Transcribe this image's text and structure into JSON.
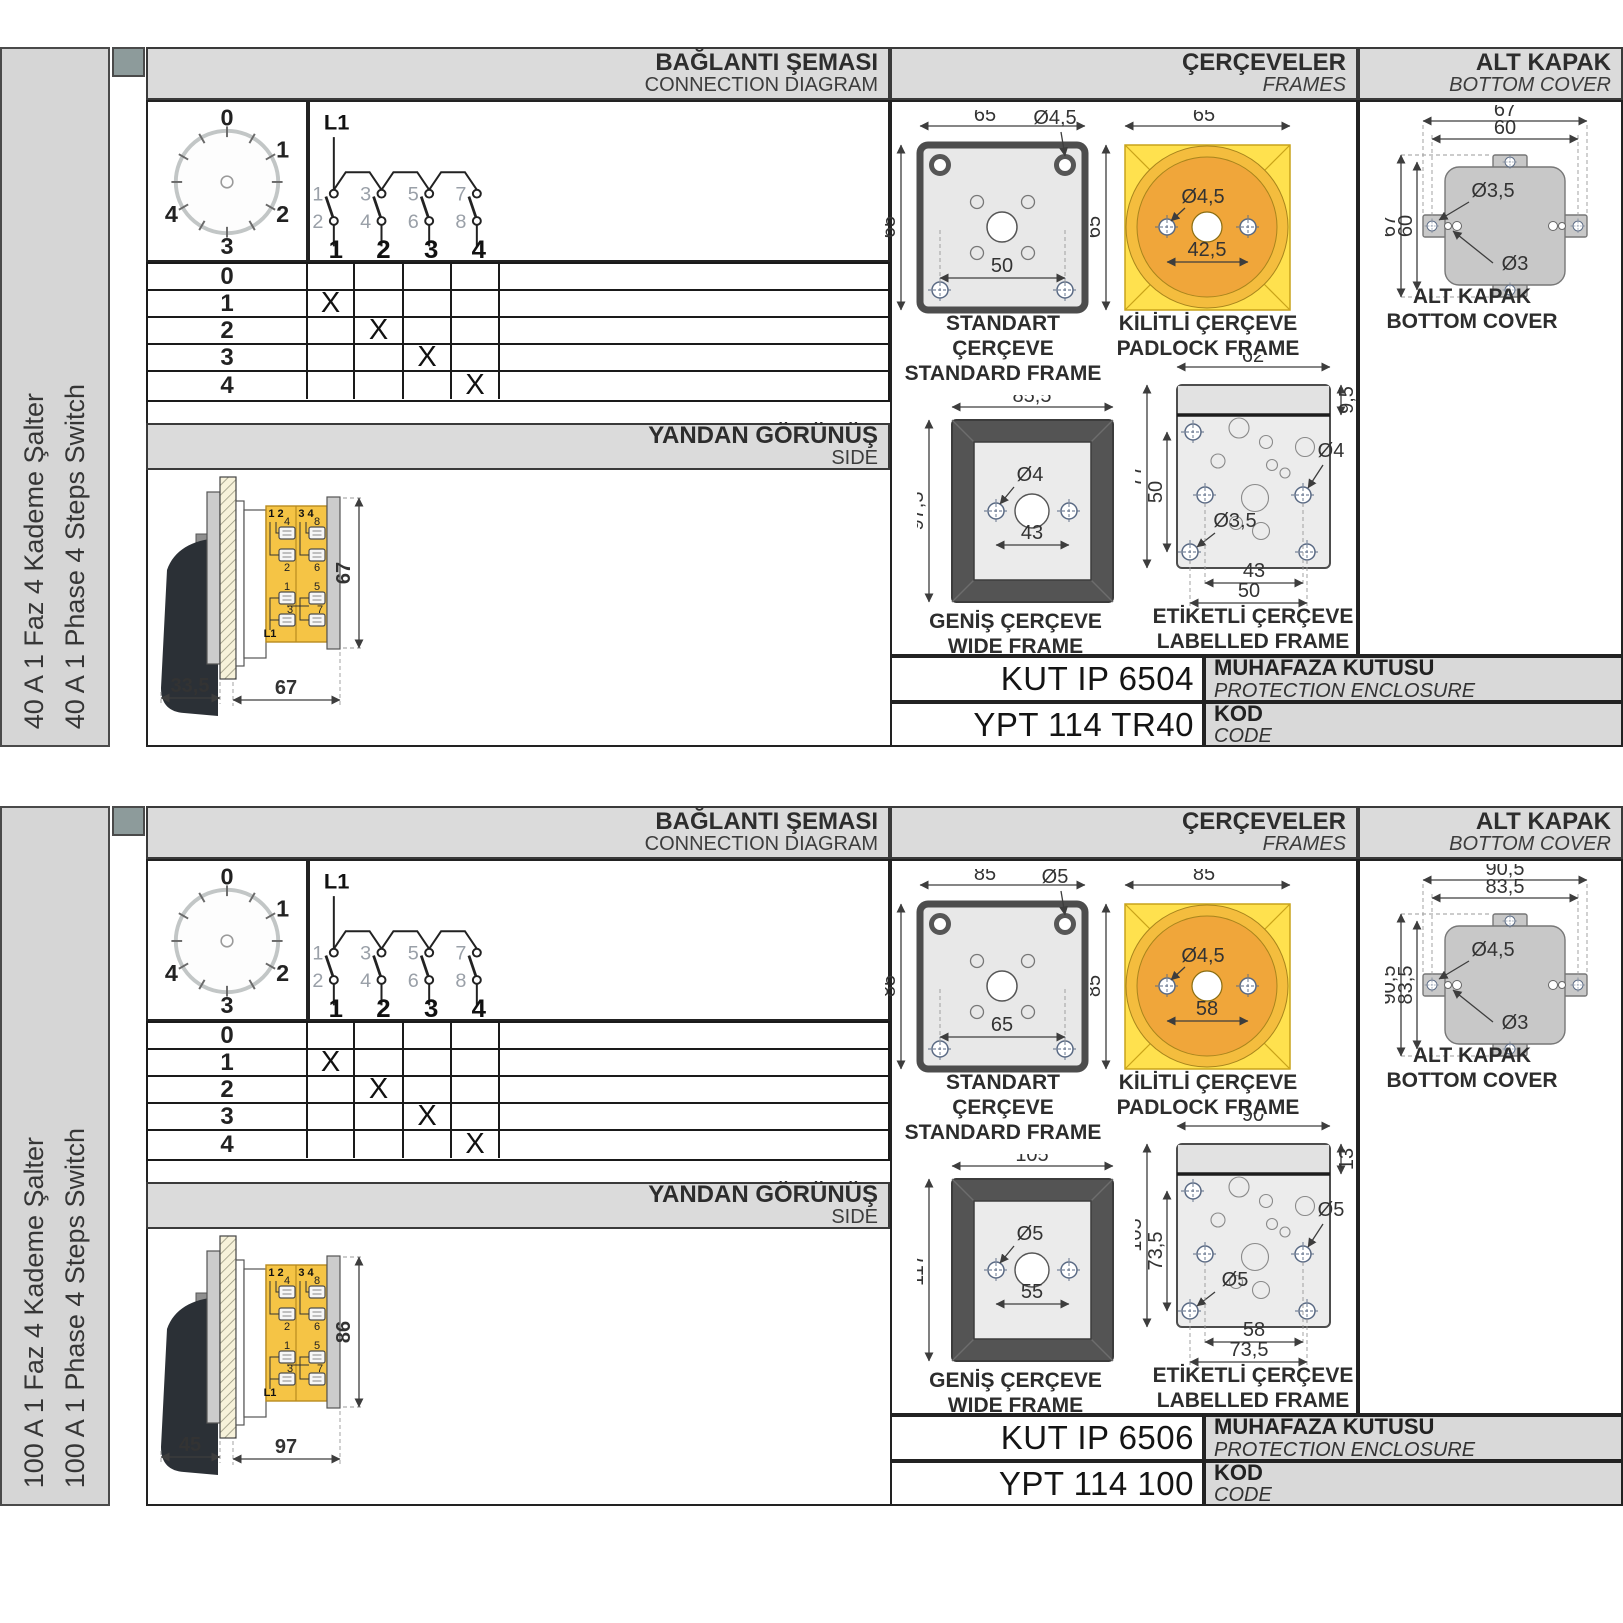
{
  "page": {
    "headers": {
      "conn_tr": "BAĞLANTI ŞEMASI",
      "conn_en": "CONNECTION DIAGRAM",
      "frames_tr": "ÇERÇEVELER",
      "frames_en": "FRAMES",
      "cover_tr": "ALT KAPAK",
      "cover_en": "BOTTOM COVER",
      "side_tr": "YANDAN GÖRÜNÜŞ",
      "side_en": "SIDE"
    },
    "captions": {
      "std_tr": "STANDART ÇERÇEVE",
      "std_en": "STANDARD FRAME",
      "pad_tr": "KİLİTLİ ÇERÇEVE",
      "pad_en": "PADLOCK FRAME",
      "wide_tr": "GENİŞ ÇERÇEVE",
      "wide_en": "WIDE FRAME",
      "lab_tr": "ETİKETLİ ÇERÇEVE",
      "lab_en": "LABELLED FRAME",
      "cover_tr": "ALT KAPAK",
      "cover_en": "BOTTOM COVER",
      "encl_tr": "MUHAFAZA KUTUSU",
      "encl_en": "PROTECTION ENCLOSURE",
      "kod_tr": "KOD",
      "kod_en": "CODE"
    },
    "dial": {
      "positions": [
        "0",
        "1",
        "2",
        "3",
        "4"
      ]
    },
    "schematic": {
      "phase": "L1",
      "upper": [
        "1",
        "3",
        "5",
        "7"
      ],
      "lower": [
        "2",
        "4",
        "6",
        "8"
      ],
      "poles": [
        "1",
        "2",
        "3",
        "4"
      ]
    },
    "side_labels": {
      "pl": "1 2",
      "pr": "3 4",
      "a1": "4",
      "a2": "8",
      "b1": "2",
      "b2": "6",
      "c1": "1",
      "c2": "5",
      "d1": "3",
      "d2": "7",
      "phase": "L1"
    },
    "table": {
      "rows": [
        {
          "label": "0",
          "cells": [
            "",
            "",
            "",
            ""
          ]
        },
        {
          "label": "1",
          "cells": [
            "X",
            "",
            "",
            ""
          ]
        },
        {
          "label": "2",
          "cells": [
            "",
            "X",
            "",
            ""
          ]
        },
        {
          "label": "3",
          "cells": [
            "",
            "",
            "X",
            ""
          ]
        },
        {
          "label": "4",
          "cells": [
            "",
            "",
            "",
            "X"
          ]
        }
      ]
    },
    "colors": {
      "band_gray": "#dbdbdb",
      "sidebar_gray": "#d6d6d6",
      "tab_square": "#8d9b9b",
      "padlock_yellow": "#ffe14e",
      "padlock_orange": "#f0a63a",
      "body_yellow": "#f5c445",
      "frame_dark": "#545454",
      "drawing_gray": "#e8e8e8",
      "cover_gray": "#c8c8c8"
    }
  },
  "sections": [
    {
      "title_tr": "40 A 1 Faz 4 Kademe Şalter",
      "title_en": "40 A 1 Phase 4 Steps Switch",
      "side": {
        "w1": "33,5",
        "w2": "67",
        "h": "67"
      },
      "standard": {
        "w": "65",
        "h": "65",
        "hole": "Ø4,5",
        "pitch": "50"
      },
      "padlock": {
        "w": "65",
        "h": "65",
        "hole": "Ø4,5",
        "pitch": "42,5"
      },
      "wide": {
        "w": "85,5",
        "h": "97,5",
        "hole": "Ø4",
        "pitch": "43"
      },
      "labelled": {
        "w": "62",
        "top": "9,5",
        "h": "77",
        "h2": "50",
        "hole_bl": "Ø3,5",
        "hole_r": "Ø4",
        "p1": "43",
        "p2": "50"
      },
      "cover": {
        "w1": "67",
        "w2": "60",
        "h1": "67",
        "h2": "60",
        "hole1": "Ø3,5",
        "hole2": "Ø3"
      },
      "enclosure": "KUT IP 6504",
      "code": "YPT 114 TR40"
    },
    {
      "title_tr": "100 A 1 Faz 4 Kademe Şalter",
      "title_en": "100 A 1 Phase 4 Steps Switch",
      "side": {
        "w1": "45",
        "w2": "97",
        "h": "86"
      },
      "standard": {
        "w": "85",
        "h": "85",
        "hole": "Ø5",
        "pitch": "65"
      },
      "padlock": {
        "w": "85",
        "h": "85",
        "hole": "Ø4,5",
        "pitch": "58"
      },
      "wide": {
        "w": "105",
        "h": "117",
        "hole": "Ø5",
        "pitch": "55"
      },
      "labelled": {
        "w": "90",
        "top": "13",
        "h": "105",
        "h2": "73,5",
        "hole_bl": "Ø5",
        "hole_r": "Ø5",
        "p1": "58",
        "p2": "73,5"
      },
      "cover": {
        "w1": "90,5",
        "w2": "83,5",
        "h1": "90,5",
        "h2": "83,5",
        "hole1": "Ø4,5",
        "hole2": "Ø3"
      },
      "enclosure": "KUT IP 6506",
      "code": "YPT 114 100"
    }
  ]
}
